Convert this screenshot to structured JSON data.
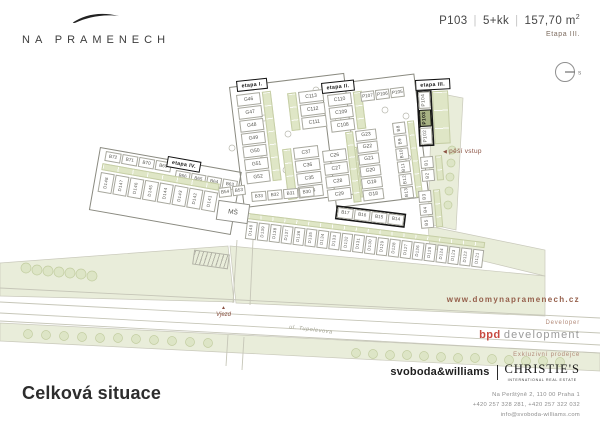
{
  "header": {
    "logo": "NA PRAMENECH",
    "unit_id": "P103",
    "separator": "|",
    "unit_layout": "5+kk",
    "unit_area": "157,70 m",
    "unit_area_sup": "2",
    "stage": "Etapa III.",
    "compass": "s"
  },
  "map": {
    "stage_labels": {
      "i": "etapa I.",
      "ii": "etapa II.",
      "iii": "etapa III.",
      "iv": "etapa IV."
    },
    "annotations": {
      "pedestrian_entry": "pěší vstup",
      "entry": "Vjezd",
      "street": "ul. Tupolevova",
      "kindergarten": "MŠ"
    },
    "highlighted_plot": "P103",
    "groups": {
      "etapa1_g": [
        "G46",
        "G47",
        "G48",
        "G49",
        "G50",
        "G51",
        "G52"
      ],
      "etapa1_c_top": [
        "C113",
        "C112",
        "C111"
      ],
      "etapa1_c_bot": [
        "C37",
        "C36",
        "C35",
        "C34"
      ],
      "etapa2_c_top": [
        "C110",
        "C109",
        "C108"
      ],
      "etapa2_c_bot": [
        "C26",
        "C27",
        "C28",
        "C29"
      ],
      "etapa2_g": [
        "G23",
        "G22",
        "G21",
        "G20",
        "G19",
        "G18"
      ],
      "etapa2_p": [
        "P107",
        "P106",
        "P105"
      ],
      "b_col": [
        "B8",
        "B9",
        "B10",
        "B11",
        "B12",
        "B13"
      ],
      "etapa3_p": [
        "P104",
        "P103",
        "P102"
      ],
      "b12": [
        "B1",
        "B2"
      ],
      "b345": [
        "B3",
        "B4",
        "B5"
      ],
      "b30s": [
        "B33",
        "B32",
        "B31",
        "B30"
      ],
      "b14s": [
        "B17",
        "B16",
        "B15",
        "B14"
      ],
      "b_iv_1": [
        "B72",
        "B71",
        "B70",
        "B69"
      ],
      "b_iv_2": [
        "B66",
        "B65",
        "B64",
        "B63"
      ],
      "b54": [
        "B54",
        "B53"
      ],
      "d_left": [
        "D148",
        "D147",
        "D146",
        "D145",
        "D144",
        "D143",
        "D142",
        "D141"
      ],
      "d_mid": [
        "D140",
        "D139",
        "D138",
        "D137",
        "D136",
        "D135",
        "D134",
        "D133",
        "D132",
        "D131",
        "D130",
        "D129",
        "D128",
        "D127",
        "D126",
        "D125",
        "D124",
        "D123",
        "D122",
        "D121"
      ]
    }
  },
  "footer": {
    "title": "Celková situace",
    "website": "www.domynapramenech.cz",
    "developer_label": "Developer",
    "developer_bold": "bpd",
    "developer_rest": "development",
    "broker_label": "Exkluzivní prodejce",
    "broker1": "svoboda&williams",
    "broker2": "CHRISTIE'S",
    "broker2_sub": "INTERNATIONAL REAL ESTATE",
    "address": "Na Perštýně 2, 110 00 Praha 1",
    "phones": "+420 257 328 281, +420 257 322 032",
    "email": "info@svoboda-williams.com"
  },
  "colors": {
    "field": "#e9edda",
    "garden": "#dfe6c6",
    "highlight": "#a8b284",
    "tree_fill": "#dde5c6",
    "tree_stroke": "#c2cda0",
    "road_line": "#c6c6b8",
    "plot_border": "#a8a89e",
    "accent_red": "#c74a40",
    "accent_brown": "#96604c",
    "label_brown": "#b28a79",
    "ink": "#2d2d2d"
  }
}
